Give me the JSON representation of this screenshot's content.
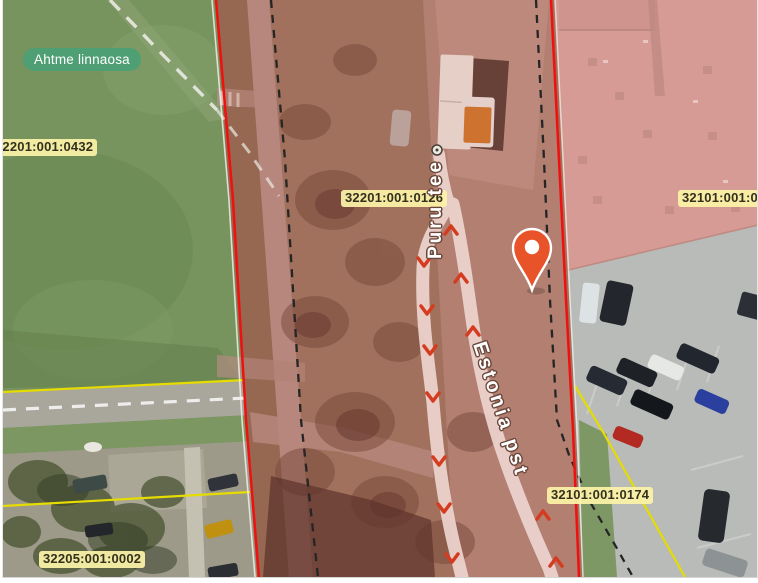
{
  "map": {
    "district_badge": "Ahtme linnaosa",
    "parcels": {
      "field_left": "32201:001:0432",
      "road_corridor": "32201:001:0126",
      "building_right": "32101:001:0",
      "parking_right": "32101:001:0174",
      "bottom_left": "32205:001:0002"
    },
    "streets": {
      "puru_tee": "Puru tee",
      "estonia_pst": "Estonia pst"
    },
    "marker": {
      "type": "location-pin",
      "color": "#e8532a"
    },
    "colors": {
      "boundary_red": "#f01010",
      "cadastral_yellow": "#e6dc00",
      "highlight_tint": "#cf3f33",
      "parcel_label_bg": "#fbf3a8",
      "district_badge_green": "#4f9f74",
      "direction_arrow_red": "#d43b1f",
      "label_dash_white": "#eaeae2"
    }
  }
}
